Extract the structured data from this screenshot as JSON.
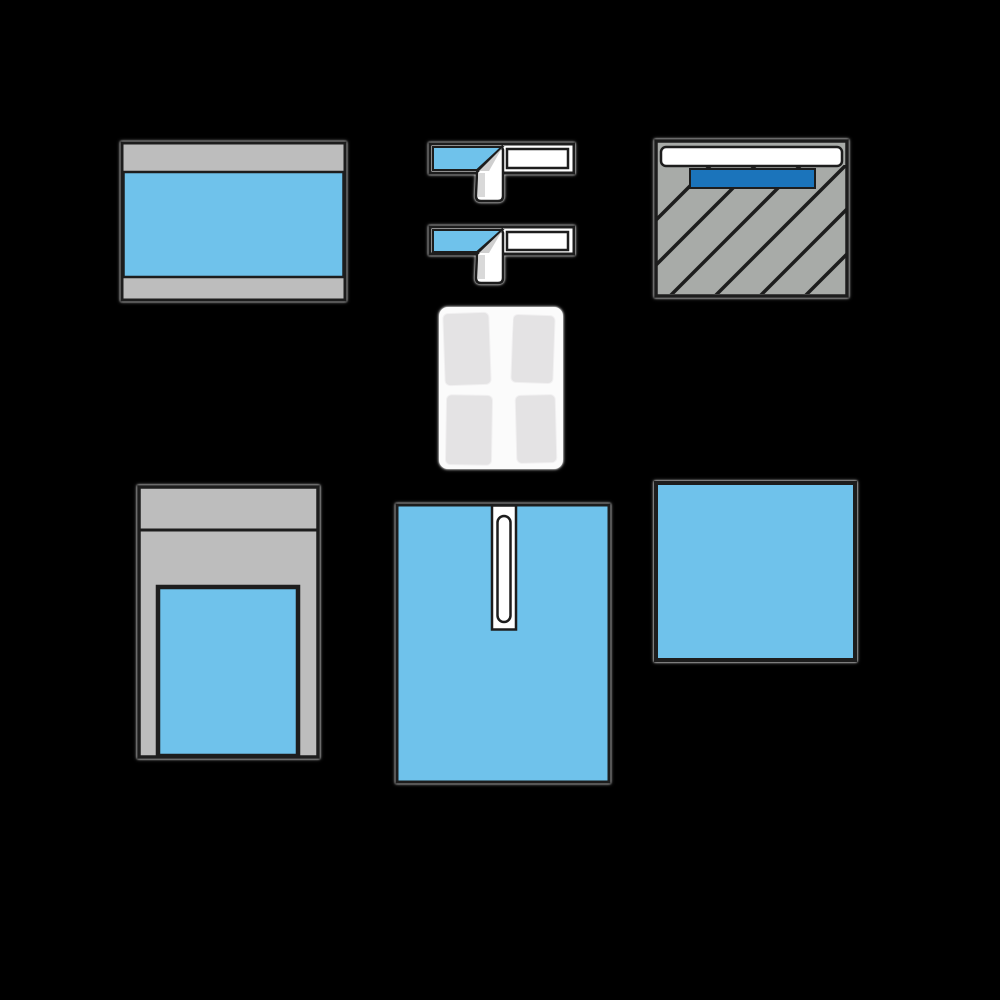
{
  "scene": {
    "type": "product-contents-image",
    "subject": "surgical-drape-pack-components",
    "background_color": "#000000",
    "grid": "three items top row, gauze stack center, three items bottom row"
  },
  "palette": {
    "background": "#000000",
    "light_blue": "#6FC2EB",
    "dark_blue": "#1B74BB",
    "gray_light": "#BDBDBD",
    "gray_medium": "#A8ABA8",
    "pad_gray": "#E4E3E4",
    "paper_white": "#FFFFFF",
    "soft_white": "#FBFBFB",
    "fold_shade": "#CFCFCF",
    "outline_dark": "#1D1D1D"
  },
  "items": [
    {
      "name": "folded-drape-with-band-edges",
      "body": "light_blue",
      "bands": "gray_light"
    },
    {
      "name": "adhesive-tape-strip-1",
      "body": "paper_white",
      "tab": "light_blue"
    },
    {
      "name": "adhesive-tape-strip-2",
      "body": "paper_white",
      "tab": "light_blue"
    },
    {
      "name": "hatched-drape-with-film-strip",
      "body": "gray_medium",
      "film": "dark_blue",
      "header": "paper_white"
    },
    {
      "name": "gauze-swab-stack",
      "pads": "pad_gray",
      "wrap": "soft_white"
    },
    {
      "name": "cover-with-window",
      "body": "gray_light",
      "window": "light_blue"
    },
    {
      "name": "slit-drape",
      "body": "light_blue",
      "slit": "paper_white"
    },
    {
      "name": "plain-drape",
      "body": "light_blue"
    }
  ]
}
